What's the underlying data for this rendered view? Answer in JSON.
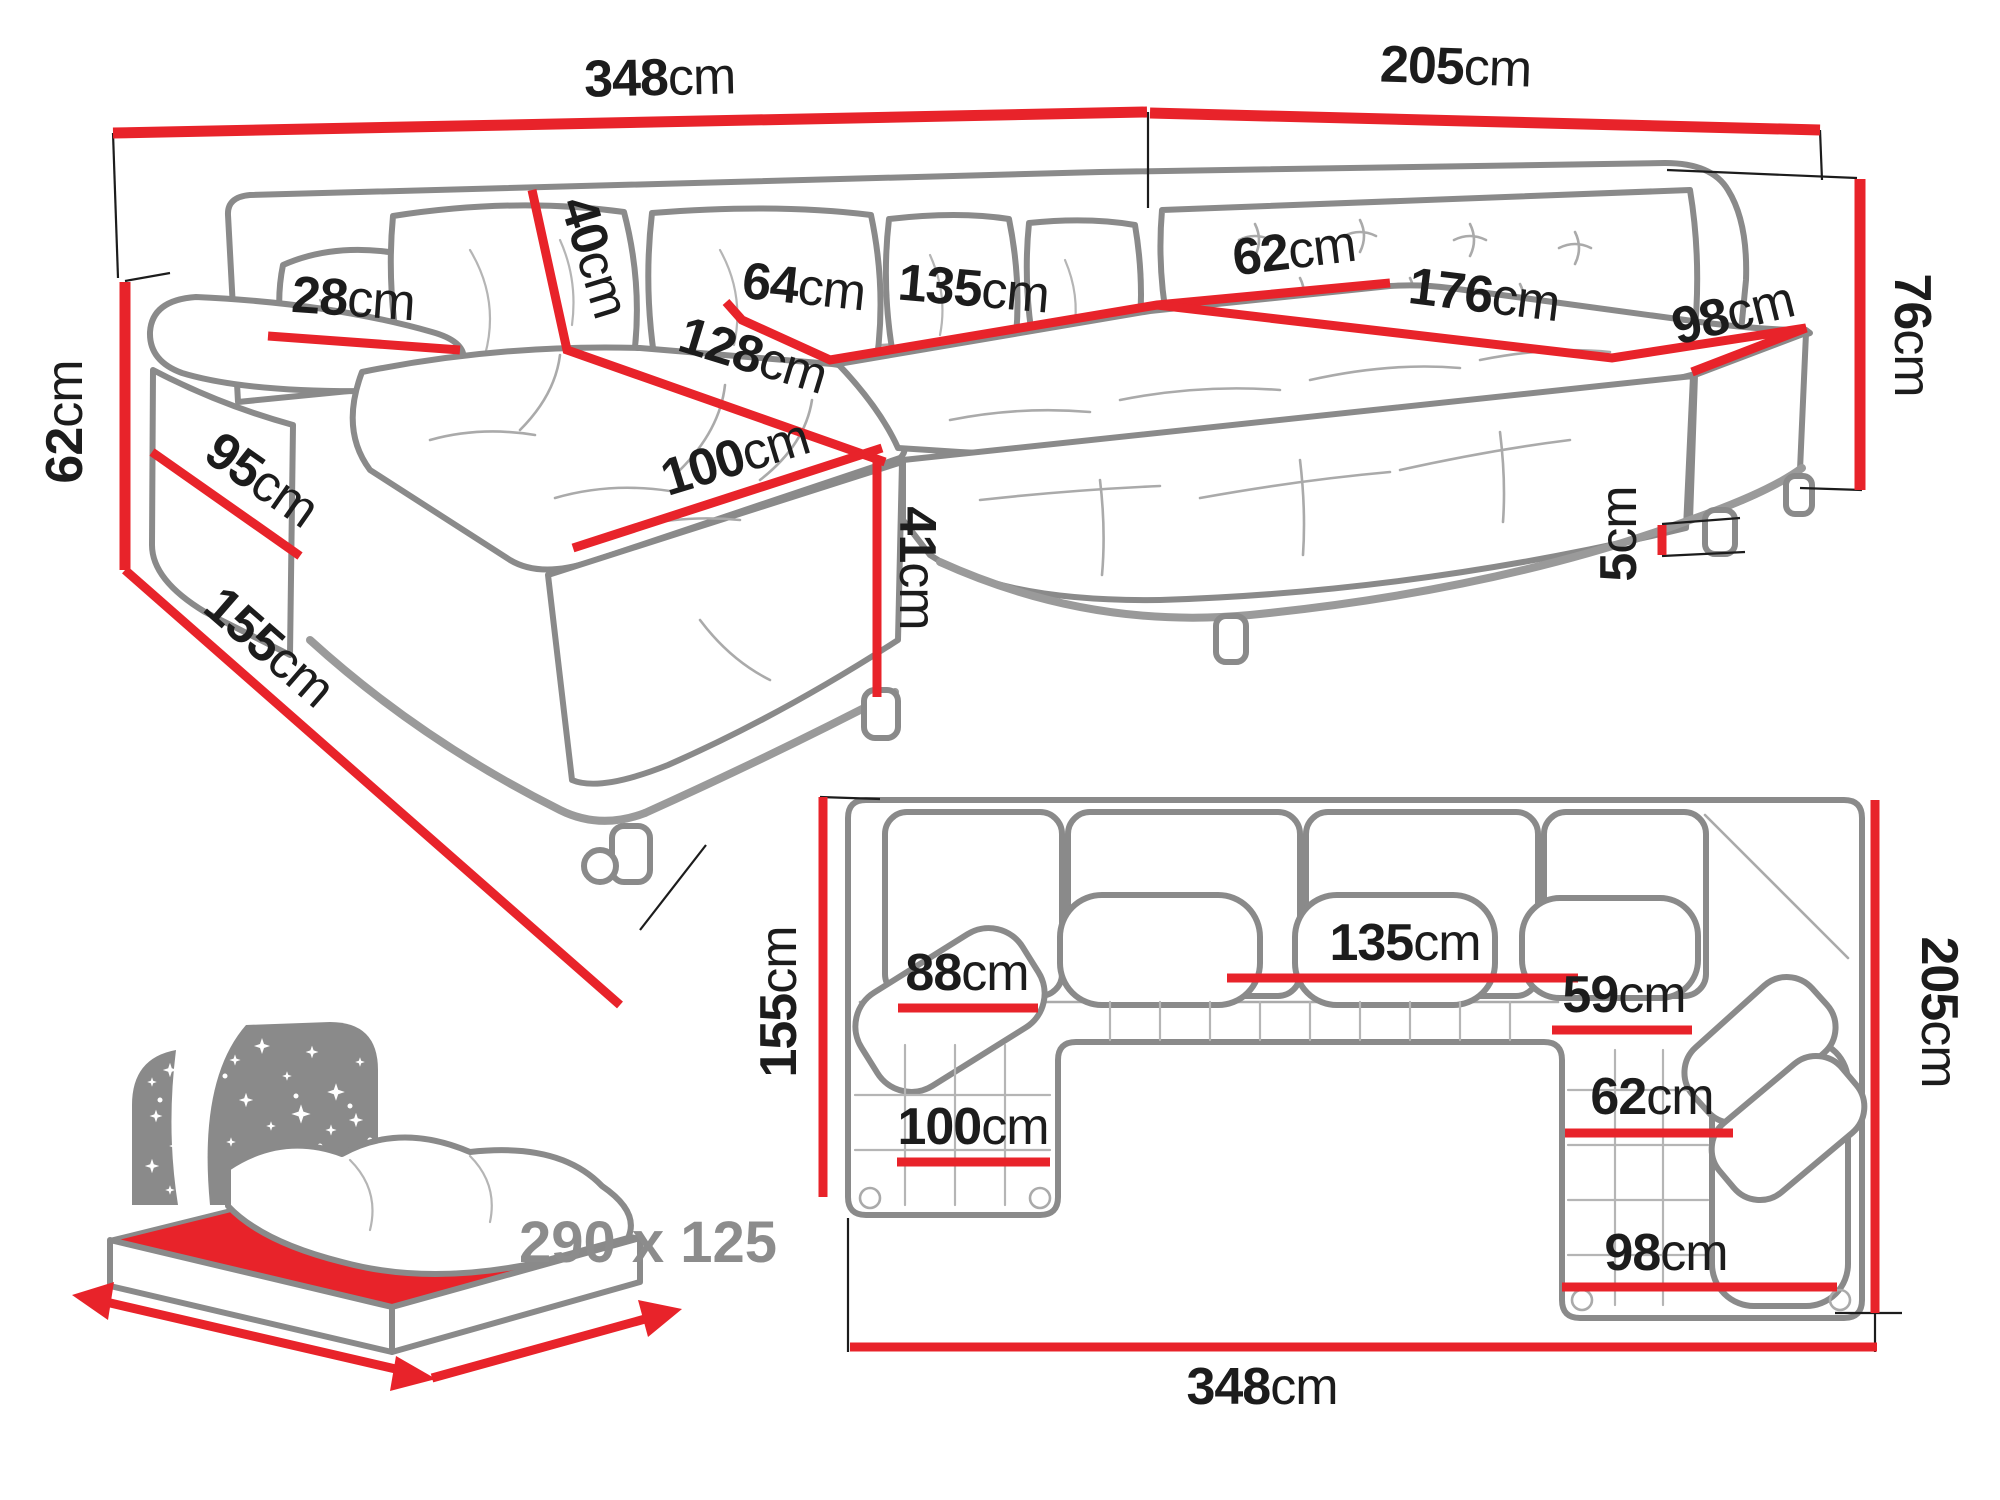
{
  "colors": {
    "dimension_red": "#e8232a",
    "outline_gray": "#8a8a8a",
    "label_black": "#1c1c1c",
    "muted_gray_text": "#8c8c8c"
  },
  "main_view": {
    "total_width": {
      "v": "348",
      "u": "cm"
    },
    "right_total_width": {
      "v": "205",
      "u": "cm"
    },
    "backrest_height": {
      "v": "76",
      "u": "cm"
    },
    "armrest_height": {
      "v": "62",
      "u": "cm"
    },
    "armrest_front_length": {
      "v": "95",
      "u": "cm"
    },
    "chaise_total_depth": {
      "v": "155",
      "u": "cm"
    },
    "armrest_top_width": {
      "v": "28",
      "u": "cm"
    },
    "back_cushion_height": {
      "v": "40",
      "u": "cm"
    },
    "seat_width_left": {
      "v": "64",
      "u": "cm"
    },
    "seat_width_middle": {
      "v": "135",
      "u": "cm"
    },
    "seat_depth_right": {
      "v": "62",
      "u": "cm"
    },
    "seat_length_right": {
      "v": "176",
      "u": "cm"
    },
    "wing_seat_width": {
      "v": "98",
      "u": "cm"
    },
    "chaise_seat_length": {
      "v": "128",
      "u": "cm"
    },
    "chaise_seat_width": {
      "v": "100",
      "u": "cm"
    },
    "seat_height": {
      "v": "41",
      "u": "cm"
    },
    "leg_height": {
      "v": "5",
      "u": "cm"
    }
  },
  "plan_view": {
    "chaise_depth": {
      "v": "155",
      "u": "cm"
    },
    "chaise_seat_width": {
      "v": "88",
      "u": "cm"
    },
    "middle_seat_width": {
      "v": "135",
      "u": "cm"
    },
    "right_seat_width": {
      "v": "59",
      "u": "cm"
    },
    "right_seat_depth": {
      "v": "62",
      "u": "cm"
    },
    "chaise_width": {
      "v": "100",
      "u": "cm"
    },
    "wing_seat_width": {
      "v": "98",
      "u": "cm"
    },
    "right_total_depth": {
      "v": "205",
      "u": "cm"
    },
    "total_width": {
      "v": "348",
      "u": "cm"
    }
  },
  "sleeping_area": {
    "dimensions": "290 x 125"
  }
}
